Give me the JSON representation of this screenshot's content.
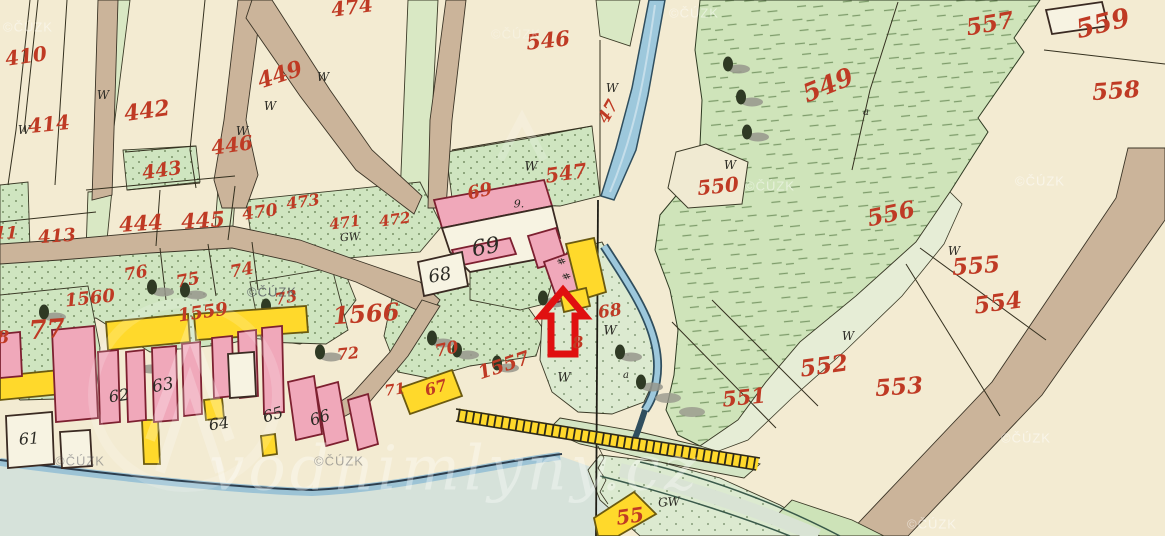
{
  "map": {
    "title": "historical cadastral map sheet",
    "palette": {
      "paper_cream": "#f3ebd2",
      "meadow_green": "#cfe4ba",
      "garden_green": "#cfe5c0",
      "pale_green": "#dcead0",
      "water_blue": "#9dc8dc",
      "road_tan": "#cbb49a",
      "building_pink": "#f0a8ba",
      "building_yellow": "#ffd92b",
      "building_white": "#f7f3e2",
      "label_red": "#bf3a24",
      "label_black": "#2b2a24",
      "arrow_red": "#e01010"
    },
    "watermark_cuzk_text": "©ČÚZK",
    "watermark_site_text": "vodnimlyny.cz",
    "cuzk_instances": [
      {
        "x": 28,
        "y": 27,
        "o": 0.45,
        "dark": false
      },
      {
        "x": 516,
        "y": 34,
        "o": 0.3,
        "dark": false
      },
      {
        "x": 694,
        "y": 13,
        "o": 0.45,
        "dark": false
      },
      {
        "x": 1040,
        "y": 181,
        "o": 0.5,
        "dark": false
      },
      {
        "x": 770,
        "y": 186,
        "o": 0.45,
        "dark": false
      },
      {
        "x": 272,
        "y": 292,
        "o": 0.75,
        "dark": true
      },
      {
        "x": 80,
        "y": 461,
        "o": 0.45,
        "dark": true
      },
      {
        "x": 339,
        "y": 461,
        "o": 0.45,
        "dark": true
      },
      {
        "x": 1026,
        "y": 438,
        "o": 0.5,
        "dark": false
      },
      {
        "x": 932,
        "y": 524,
        "o": 0.5,
        "dark": false
      }
    ],
    "labels": [
      {
        "t": "410",
        "x": 26,
        "y": 56,
        "s": 20,
        "r": -8,
        "c": "r"
      },
      {
        "t": "414",
        "x": 49,
        "y": 124,
        "s": 20,
        "r": -6,
        "c": "r"
      },
      {
        "t": "442",
        "x": 147,
        "y": 111,
        "s": 22,
        "r": -8,
        "c": "r"
      },
      {
        "t": "446",
        "x": 232,
        "y": 145,
        "s": 20,
        "r": -8,
        "c": "r"
      },
      {
        "t": "443",
        "x": 162,
        "y": 171,
        "s": 19,
        "r": -8,
        "c": "r"
      },
      {
        "t": "449",
        "x": 280,
        "y": 75,
        "s": 22,
        "r": -18,
        "c": "r"
      },
      {
        "t": "474",
        "x": 352,
        "y": 7,
        "s": 20,
        "r": -8,
        "c": "r"
      },
      {
        "t": "413",
        "x": 57,
        "y": 237,
        "s": 18,
        "r": -4,
        "c": "r"
      },
      {
        "t": "411",
        "x": 0,
        "y": 234,
        "s": 17,
        "r": 0,
        "c": "r"
      },
      {
        "t": "444",
        "x": 141,
        "y": 223,
        "s": 21,
        "r": -4,
        "c": "r"
      },
      {
        "t": "445",
        "x": 203,
        "y": 220,
        "s": 21,
        "r": -4,
        "c": "r"
      },
      {
        "t": "470",
        "x": 260,
        "y": 213,
        "s": 17,
        "r": -8,
        "c": "r"
      },
      {
        "t": "473",
        "x": 303,
        "y": 202,
        "s": 16,
        "r": -8,
        "c": "r"
      },
      {
        "t": "471",
        "x": 345,
        "y": 223,
        "s": 15,
        "r": -8,
        "c": "r"
      },
      {
        "t": "472",
        "x": 395,
        "y": 220,
        "s": 15,
        "r": -8,
        "c": "r"
      },
      {
        "t": "546",
        "x": 548,
        "y": 40,
        "s": 21,
        "r": -6,
        "c": "r"
      },
      {
        "t": "47",
        "x": 609,
        "y": 112,
        "s": 17,
        "r": -60,
        "c": "r"
      },
      {
        "t": "547",
        "x": 566,
        "y": 173,
        "s": 20,
        "r": -8,
        "c": "r"
      },
      {
        "t": "549",
        "x": 828,
        "y": 85,
        "s": 25,
        "r": -22,
        "c": "r"
      },
      {
        "t": "550",
        "x": 718,
        "y": 186,
        "s": 20,
        "r": -6,
        "c": "r"
      },
      {
        "t": "557",
        "x": 990,
        "y": 24,
        "s": 23,
        "r": -10,
        "c": "r"
      },
      {
        "t": "559",
        "x": 1103,
        "y": 24,
        "s": 26,
        "r": -14,
        "c": "r"
      },
      {
        "t": "558",
        "x": 1116,
        "y": 91,
        "s": 23,
        "r": -4,
        "c": "r"
      },
      {
        "t": "556",
        "x": 891,
        "y": 214,
        "s": 23,
        "r": -12,
        "c": "r"
      },
      {
        "t": "555",
        "x": 976,
        "y": 266,
        "s": 23,
        "r": -4,
        "c": "r"
      },
      {
        "t": "554",
        "x": 998,
        "y": 303,
        "s": 23,
        "r": -8,
        "c": "r"
      },
      {
        "t": "553",
        "x": 899,
        "y": 387,
        "s": 23,
        "r": -4,
        "c": "r"
      },
      {
        "t": "552",
        "x": 824,
        "y": 366,
        "s": 23,
        "r": -8,
        "c": "r"
      },
      {
        "t": "551",
        "x": 744,
        "y": 397,
        "s": 21,
        "r": -6,
        "c": "r"
      },
      {
        "t": "69",
        "x": 480,
        "y": 192,
        "s": 18,
        "r": -12,
        "c": "r"
      },
      {
        "t": "1566",
        "x": 366,
        "y": 314,
        "s": 24,
        "r": -4,
        "c": "r"
      },
      {
        "t": "1560",
        "x": 90,
        "y": 299,
        "s": 18,
        "r": -6,
        "c": "r"
      },
      {
        "t": "1559",
        "x": 203,
        "y": 313,
        "s": 18,
        "r": -8,
        "c": "r"
      },
      {
        "t": "76",
        "x": 136,
        "y": 274,
        "s": 17,
        "r": -10,
        "c": "r"
      },
      {
        "t": "75",
        "x": 188,
        "y": 281,
        "s": 17,
        "r": -10,
        "c": "r"
      },
      {
        "t": "74",
        "x": 242,
        "y": 271,
        "s": 17,
        "r": -10,
        "c": "r"
      },
      {
        "t": "73",
        "x": 286,
        "y": 298,
        "s": 16,
        "r": -10,
        "c": "r"
      },
      {
        "t": "72",
        "x": 348,
        "y": 354,
        "s": 16,
        "r": -6,
        "c": "r"
      },
      {
        "t": "71",
        "x": 395,
        "y": 390,
        "s": 15,
        "r": -8,
        "c": "r"
      },
      {
        "t": "77",
        "x": 47,
        "y": 330,
        "s": 26,
        "r": -4,
        "c": "r"
      },
      {
        "t": "8",
        "x": 3,
        "y": 338,
        "s": 18,
        "r": 0,
        "c": "r"
      },
      {
        "t": "70",
        "x": 447,
        "y": 350,
        "s": 17,
        "r": -12,
        "c": "r"
      },
      {
        "t": "1557",
        "x": 504,
        "y": 366,
        "s": 19,
        "r": -18,
        "c": "r"
      },
      {
        "t": "67",
        "x": 436,
        "y": 388,
        "s": 16,
        "r": -16,
        "c": "r"
      },
      {
        "t": "68",
        "x": 610,
        "y": 312,
        "s": 17,
        "r": -8,
        "c": "r"
      },
      {
        "t": "8",
        "x": 578,
        "y": 343,
        "s": 16,
        "r": -6,
        "c": "r"
      },
      {
        "t": "55",
        "x": 630,
        "y": 516,
        "s": 20,
        "r": -8,
        "c": "r"
      },
      {
        "t": "69",
        "x": 486,
        "y": 248,
        "s": 22,
        "r": -10,
        "c": "k"
      },
      {
        "t": "68",
        "x": 440,
        "y": 276,
        "s": 18,
        "r": -10,
        "c": "k"
      },
      {
        "t": "9.",
        "x": 519,
        "y": 204,
        "s": 11,
        "r": 0,
        "c": "k"
      },
      {
        "t": "61",
        "x": 29,
        "y": 439,
        "s": 16,
        "r": -4,
        "c": "k"
      },
      {
        "t": "62",
        "x": 119,
        "y": 396,
        "s": 16,
        "r": -8,
        "c": "k"
      },
      {
        "t": "63",
        "x": 163,
        "y": 386,
        "s": 17,
        "r": -10,
        "c": "k"
      },
      {
        "t": "64",
        "x": 219,
        "y": 424,
        "s": 16,
        "r": -8,
        "c": "k"
      },
      {
        "t": "65",
        "x": 273,
        "y": 415,
        "s": 16,
        "r": -16,
        "c": "k"
      },
      {
        "t": "66",
        "x": 320,
        "y": 418,
        "s": 16,
        "r": -18,
        "c": "k"
      },
      {
        "t": "GW",
        "x": 350,
        "y": 237,
        "s": 11,
        "r": -4,
        "c": "k"
      },
      {
        "t": "GW",
        "x": 669,
        "y": 502,
        "s": 12,
        "r": -4,
        "c": "k"
      },
      {
        "t": "a",
        "x": 866,
        "y": 113,
        "s": 10,
        "r": 0,
        "c": "k"
      },
      {
        "t": "a",
        "x": 626,
        "y": 376,
        "s": 10,
        "r": 0,
        "c": "k"
      },
      {
        "t": "W",
        "x": 24,
        "y": 130,
        "s": 12,
        "r": 0,
        "c": "k"
      },
      {
        "t": "W",
        "x": 103,
        "y": 95,
        "s": 12,
        "r": 0,
        "c": "k"
      },
      {
        "t": "W",
        "x": 242,
        "y": 131,
        "s": 12,
        "r": 0,
        "c": "k"
      },
      {
        "t": "W",
        "x": 270,
        "y": 106,
        "s": 12,
        "r": 0,
        "c": "k"
      },
      {
        "t": "W",
        "x": 323,
        "y": 77,
        "s": 12,
        "r": 0,
        "c": "k"
      },
      {
        "t": "W",
        "x": 531,
        "y": 167,
        "s": 13,
        "r": 0,
        "c": "k"
      },
      {
        "t": "W",
        "x": 612,
        "y": 88,
        "s": 12,
        "r": 0,
        "c": "k"
      },
      {
        "t": "W",
        "x": 730,
        "y": 165,
        "s": 12,
        "r": 0,
        "c": "k"
      },
      {
        "t": "W",
        "x": 954,
        "y": 251,
        "s": 12,
        "r": 0,
        "c": "k"
      },
      {
        "t": "W",
        "x": 848,
        "y": 336,
        "s": 12,
        "r": 0,
        "c": "k"
      },
      {
        "t": "W",
        "x": 610,
        "y": 331,
        "s": 13,
        "r": 0,
        "c": "k"
      },
      {
        "t": "W",
        "x": 564,
        "y": 378,
        "s": 13,
        "r": 0,
        "c": "k"
      },
      {
        "t": "#",
        "x": 560,
        "y": 262,
        "s": 10,
        "r": 60,
        "c": "k"
      },
      {
        "t": "#",
        "x": 565,
        "y": 277,
        "s": 10,
        "r": 60,
        "c": "k"
      }
    ],
    "buildings": [
      {
        "f": "pink",
        "pts": "434,200 544,180 552,206 442,228"
      },
      {
        "f": "white",
        "pts": "442,228 552,206 560,238 540,244 544,258 470,272 450,252"
      },
      {
        "f": "pink",
        "pts": "528,236 556,228 566,260 538,268"
      },
      {
        "f": "pink",
        "pts": "544,262 572,252 586,292 558,302"
      },
      {
        "f": "pink",
        "pts": "452,250 510,238 516,254 458,266"
      },
      {
        "f": "white",
        "pts": "418,262 462,252 468,286 424,296"
      },
      {
        "f": "yellow",
        "pts": "566,244 594,238 606,292 580,300"
      },
      {
        "f": "yellow",
        "pts": "560,294 586,288 590,306 564,312"
      },
      {
        "f": "yellow",
        "pts": "106,322 188,314 190,342 108,350"
      },
      {
        "f": "yellow",
        "pts": "194,314 306,306 308,332 196,340"
      },
      {
        "f": "yellow",
        "pts": "0,376 60,370 62,394 0,400"
      },
      {
        "f": "yellow",
        "pts": "204,400 222,398 224,418 206,420"
      },
      {
        "f": "yellow",
        "pts": "142,420 158,420 160,464 144,464"
      },
      {
        "f": "yellow",
        "pts": "261,436 275,434 277,454 263,456"
      },
      {
        "f": "pink",
        "pts": "52,330 94,326 98,418 56,422"
      },
      {
        "f": "pink",
        "pts": "98,352 118,350 120,422 100,424"
      },
      {
        "f": "pink",
        "pts": "126,352 144,350 146,420 128,422"
      },
      {
        "f": "pink",
        "pts": "152,348 176,346 178,420 154,422"
      },
      {
        "f": "pink",
        "pts": "182,344 200,342 202,414 184,416"
      },
      {
        "f": "pink",
        "pts": "212,338 232,336 234,396 214,398"
      },
      {
        "f": "pink",
        "pts": "238,332 256,330 258,396 240,398"
      },
      {
        "f": "pink",
        "pts": "262,328 282,326 284,412 264,414"
      },
      {
        "f": "pink",
        "pts": "288,382 314,376 322,434 296,440"
      },
      {
        "f": "pink",
        "pts": "316,388 338,382 348,440 326,446"
      },
      {
        "f": "pink",
        "pts": "0,334 20,332 22,376 0,378"
      },
      {
        "f": "pink",
        "pts": "348,400 368,394 378,444 358,450"
      },
      {
        "f": "white",
        "pts": "6,416 52,412 54,464 8,468"
      },
      {
        "f": "white",
        "pts": "228,354 254,352 256,396 230,398"
      },
      {
        "f": "white",
        "pts": "60,432 90,430 92,466 62,468"
      },
      {
        "f": "yellow",
        "pts": "594,518 634,492 656,514 618,536 598,536"
      },
      {
        "f": "yellow",
        "pts": "400,388 452,370 462,396 410,414"
      },
      {
        "f": "white",
        "pts": "1046,10 1102,2 1108,26 1052,34"
      }
    ],
    "trees": [
      {
        "x": 728,
        "y": 64
      },
      {
        "x": 741,
        "y": 97
      },
      {
        "x": 747,
        "y": 132
      },
      {
        "x": 620,
        "y": 352
      },
      {
        "x": 641,
        "y": 382
      },
      {
        "x": 432,
        "y": 338
      },
      {
        "x": 457,
        "y": 350
      },
      {
        "x": 543,
        "y": 298
      },
      {
        "x": 152,
        "y": 287
      },
      {
        "x": 185,
        "y": 290
      },
      {
        "x": 320,
        "y": 352
      },
      {
        "x": 266,
        "y": 306
      },
      {
        "x": 44,
        "y": 312
      },
      {
        "x": 140,
        "y": 364
      },
      {
        "x": 497,
        "y": 363
      }
    ],
    "shadows": [
      {
        "x": 668,
        "y": 398
      },
      {
        "x": 692,
        "y": 412
      },
      {
        "x": 556,
        "y": 302
      }
    ]
  }
}
